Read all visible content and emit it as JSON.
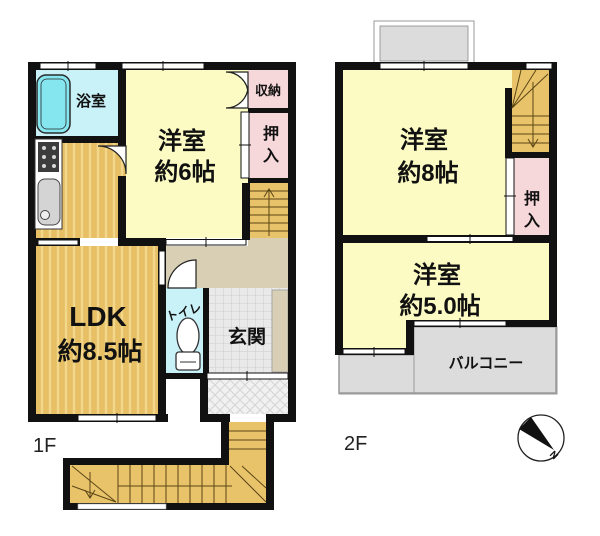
{
  "floor1": {
    "label": "1F",
    "bath_label": "浴室",
    "room6": {
      "name": "洋室",
      "size": "約6帖"
    },
    "storage_label": "収納",
    "closet_chars": [
      "押",
      "入"
    ],
    "ldk": {
      "name": "LDK",
      "size": "約8.5帖"
    },
    "toilet_label": "トイレ",
    "entrance_label": "玄関"
  },
  "floor2": {
    "label": "2F",
    "room8": {
      "name": "洋室",
      "size": "約8帖"
    },
    "closet_chars": [
      "押",
      "入"
    ],
    "room5": {
      "name": "洋室",
      "size": "約5.0帖"
    },
    "balcony_label": "バルコニー"
  },
  "compass": {
    "north_label": "N"
  },
  "colors": {
    "wall": "#111111",
    "room_yellow": "#fbfbc3",
    "closet_pink": "#f6d7da",
    "bath_cyan": "#c9f1f8",
    "bathtub_cyan": "#85e6ef",
    "wood_floor": "#e7c066",
    "wood_stripe": "#f3d88c",
    "hallway_beige": "#d8cfb4",
    "stair_tan": "#e9c369",
    "entrance_gray": "#e9e9e9",
    "porch_gray": "#f1f1f1",
    "balcony_gray": "#dcdcdc"
  }
}
